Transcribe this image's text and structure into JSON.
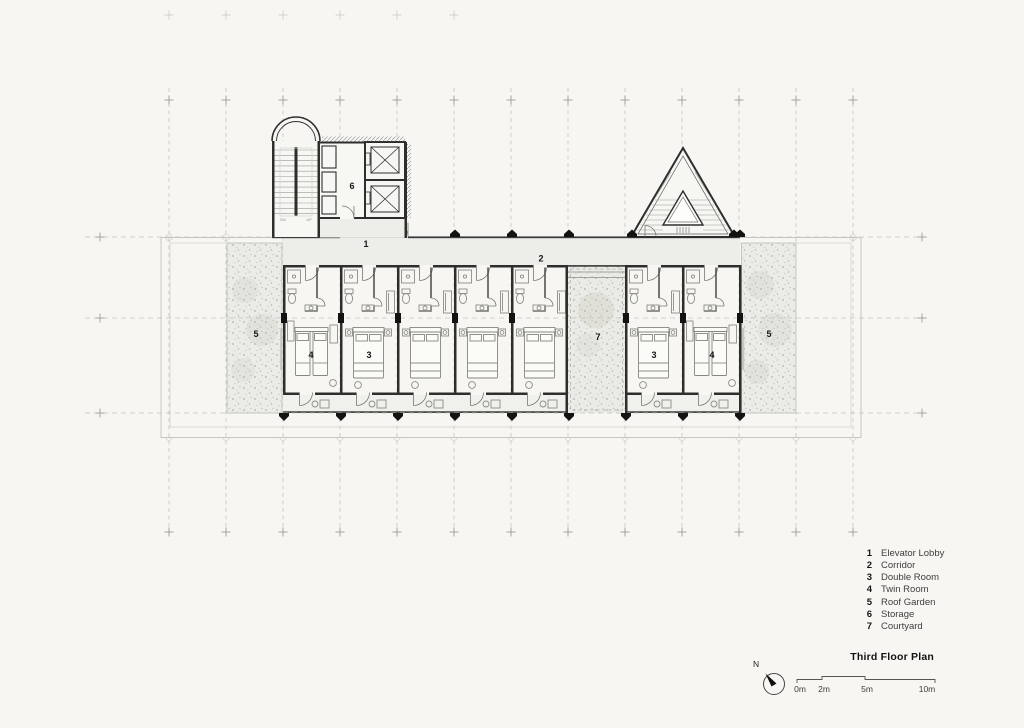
{
  "document": {
    "type": "architectural floor plan drawing",
    "paper_color": "#f7f6f3"
  },
  "plan": {
    "labels": [
      {
        "num": "1",
        "room": "elevator lobby"
      },
      {
        "num": "2",
        "room": "corridor"
      },
      {
        "num": "6",
        "room": "storage"
      },
      {
        "num": "5",
        "room": "roof garden left"
      },
      {
        "num": "4",
        "room": "twin room left"
      },
      {
        "num": "3",
        "room": "double room left"
      },
      {
        "num": "7",
        "room": "courtyard"
      },
      {
        "num": "3",
        "room": "double room right"
      },
      {
        "num": "4",
        "room": "twin room right"
      },
      {
        "num": "5",
        "room": "roof garden right"
      }
    ],
    "stair": {
      "down": "DN",
      "up": "UP"
    },
    "colors": {
      "ink": "#2e2e2c",
      "light_fill": "#ededea",
      "garden_fill": "#ebebe7",
      "grid": "#bcbcb7",
      "marker_black": "#131312"
    }
  },
  "legend": {
    "items": [
      {
        "num": "1",
        "label": "Elevator Lobby"
      },
      {
        "num": "2",
        "label": "Corridor"
      },
      {
        "num": "3",
        "label": "Double Room"
      },
      {
        "num": "4",
        "label": "Twin Room"
      },
      {
        "num": "5",
        "label": "Roof Garden"
      },
      {
        "num": "6",
        "label": "Storage"
      },
      {
        "num": "7",
        "label": "Courtyard"
      }
    ]
  },
  "title_block": {
    "title": "Third Floor Plan",
    "north_label": "N",
    "scale_labels": [
      "0m",
      "2m",
      "5m",
      "10m"
    ]
  }
}
